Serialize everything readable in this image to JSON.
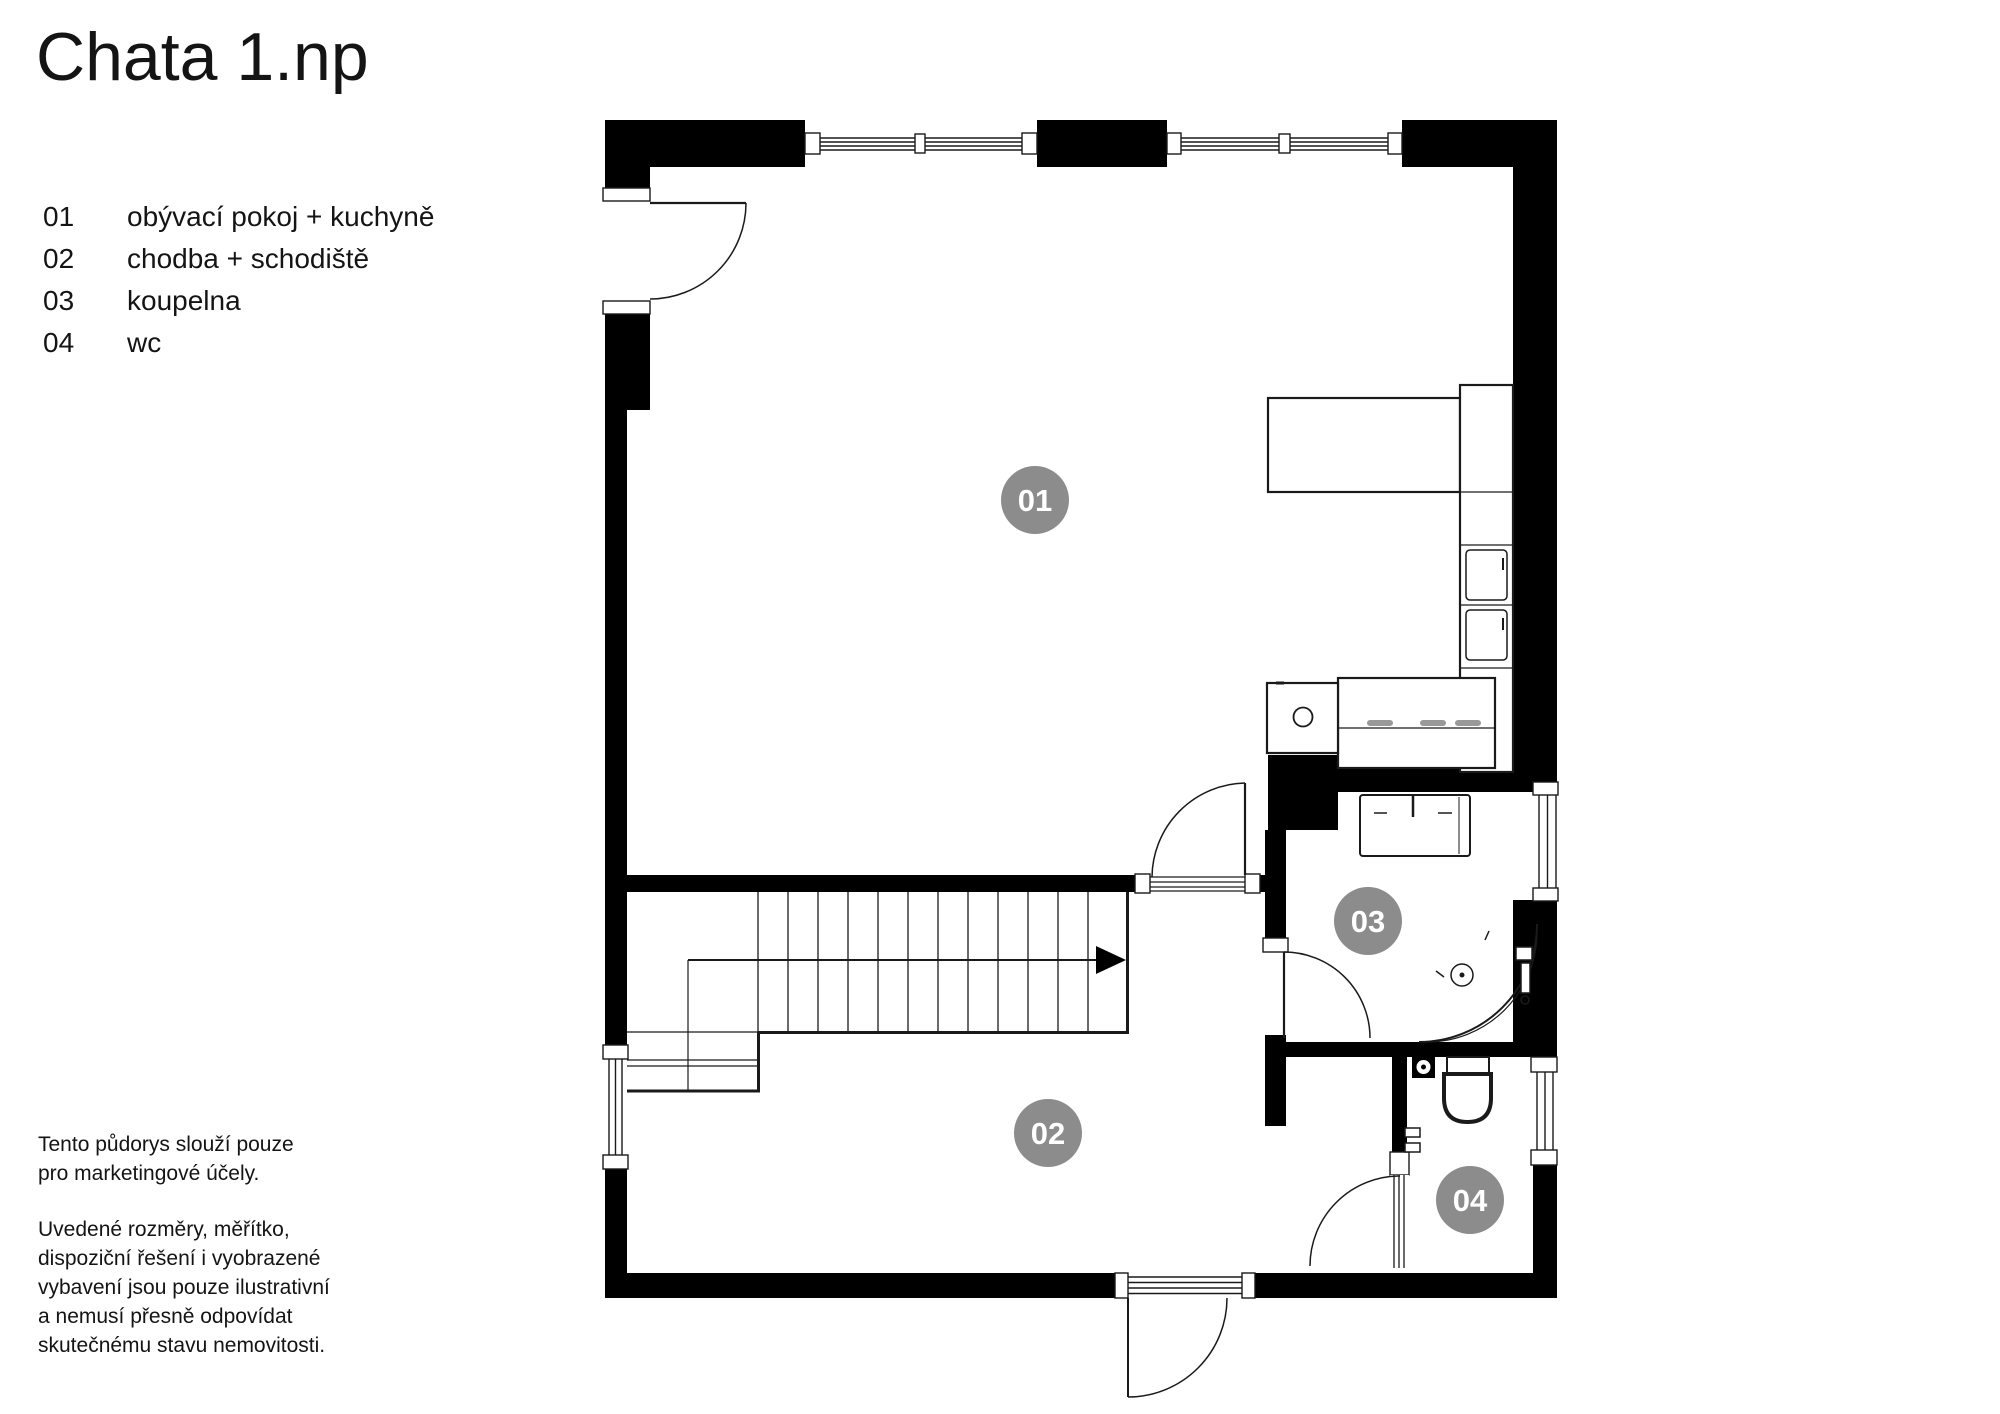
{
  "title": "Chata 1.np",
  "legend": {
    "items": [
      {
        "num": "01",
        "label": "obývací pokoj + kuchyně"
      },
      {
        "num": "02",
        "label": "chodba + schodiště"
      },
      {
        "num": "03",
        "label": "koupelna"
      },
      {
        "num": "04",
        "label": "wc"
      }
    ]
  },
  "disclaimer": {
    "para1_lines": [
      "Tento půdorys slouží pouze",
      "pro marketingové účely."
    ],
    "para2_lines": [
      "Uvedené rozměry, měřítko,",
      "dispoziční řešení i vyobrazené",
      "vybavení jsou pouze ilustrativní",
      "a nemusí přesně odpovídat",
      "skutečnému stavu nemovitosti."
    ]
  },
  "plan": {
    "colors": {
      "wall": "#000000",
      "line": "#1a1a1a",
      "room_badge": "#8c8c8c",
      "badge_text": "#ffffff",
      "fixture_gray": "#999999"
    }
  }
}
